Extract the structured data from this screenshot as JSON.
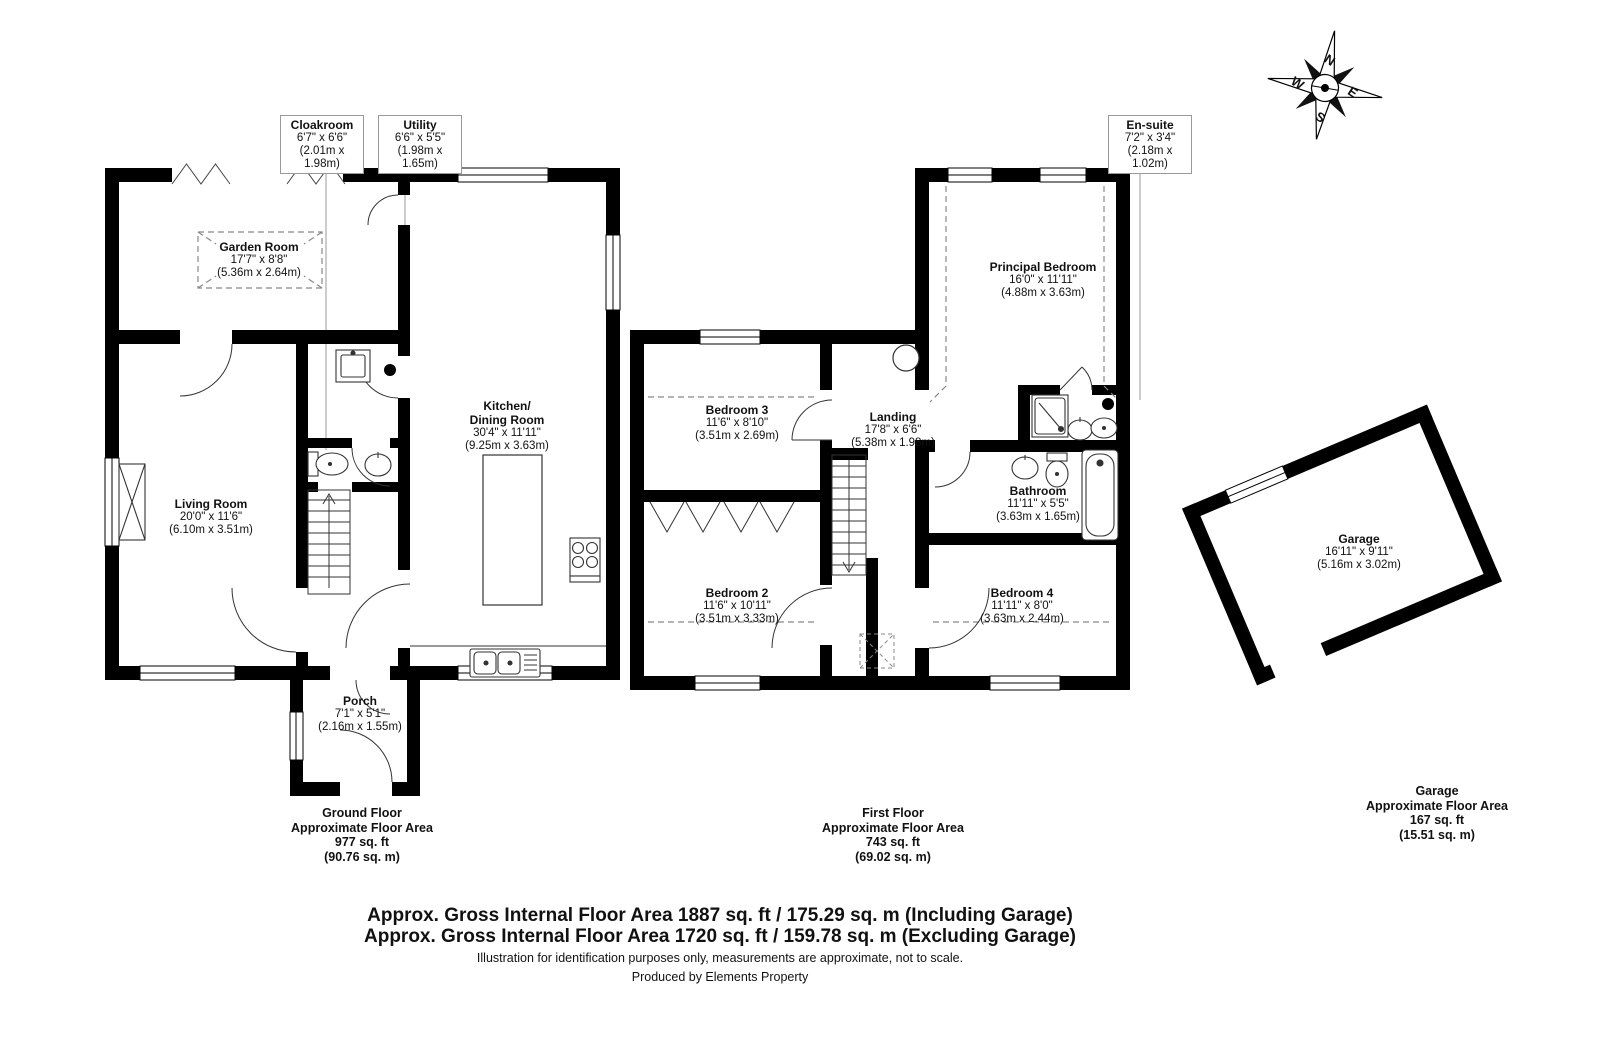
{
  "compass": {
    "north": "N",
    "east": "E",
    "south": "S",
    "west": "W"
  },
  "ground_floor": {
    "callout_cloakroom": {
      "name": "Cloakroom",
      "imperial": "6'7\" x 6'6\"",
      "metric": "(2.01m x 1.98m)"
    },
    "callout_utility": {
      "name": "Utility",
      "imperial": "6'6\" x 5'5\"",
      "metric": "(1.98m x 1.65m)"
    },
    "garden_room": {
      "name": "Garden Room",
      "imperial": "17'7\" x 8'8\"",
      "metric": "(5.36m x 2.64m)"
    },
    "living_room": {
      "name": "Living Room",
      "imperial": "20'0\" x 11'6\"",
      "metric": "(6.10m x 3.51m)"
    },
    "kitchen_dining": {
      "name_line1": "Kitchen/",
      "name_line2": "Dining Room",
      "imperial": "30'4\" x 11'11\"",
      "metric": "(9.25m x 3.63m)"
    },
    "porch": {
      "name": "Porch",
      "imperial": "7'1\" x 5'1\"",
      "metric": "(2.16m x 1.55m)"
    },
    "summary": {
      "title": "Ground Floor",
      "subtitle": "Approximate Floor Area",
      "area_sqft": "977 sq. ft",
      "area_sqm": "(90.76 sq. m)"
    }
  },
  "first_floor": {
    "callout_ensuite": {
      "name": "En-suite",
      "imperial": "7'2\" x 3'4\"",
      "metric": "(2.18m x 1.02m)"
    },
    "principal_bedroom": {
      "name": "Principal Bedroom",
      "imperial": "16'0\" x 11'11\"",
      "metric": "(4.88m x 3.63m)"
    },
    "bedroom_3": {
      "name": "Bedroom 3",
      "imperial": "11'6\" x 8'10\"",
      "metric": "(3.51m x 2.69m)"
    },
    "landing": {
      "name": "Landing",
      "imperial": "17'8\" x 6'6\"",
      "metric": "(5.38m x 1.98m)"
    },
    "bathroom": {
      "name": "Bathroom",
      "imperial": "11'11\" x 5'5\"",
      "metric": "(3.63m x 1.65m)"
    },
    "bedroom_2": {
      "name": "Bedroom 2",
      "imperial": "11'6\" x 10'11\"",
      "metric": "(3.51m x 3.33m)"
    },
    "bedroom_4": {
      "name": "Bedroom 4",
      "imperial": "11'11\" x 8'0\"",
      "metric": "(3.63m x 2.44m)"
    },
    "summary": {
      "title": "First Floor",
      "subtitle": "Approximate Floor Area",
      "area_sqft": "743 sq. ft",
      "area_sqm": "(69.02 sq. m)"
    }
  },
  "garage": {
    "room": {
      "name": "Garage",
      "imperial": "16'11\" x 9'11\"",
      "metric": "(5.16m x 3.02m)"
    },
    "summary": {
      "title": "Garage",
      "subtitle": "Approximate Floor Area",
      "area_sqft": "167 sq. ft",
      "area_sqm": "(15.51 sq. m)"
    }
  },
  "footer": {
    "gross_area_including": "Approx. Gross Internal Floor Area 1887 sq. ft / 175.29 sq. m (Including Garage)",
    "gross_area_excluding": "Approx. Gross Internal Floor Area 1720 sq. ft / 159.78 sq. m (Excluding Garage)",
    "disclaimer": "Illustration for identification purposes only, measurements are approximate, not to scale.",
    "credit": "Produced by Elements Property"
  }
}
